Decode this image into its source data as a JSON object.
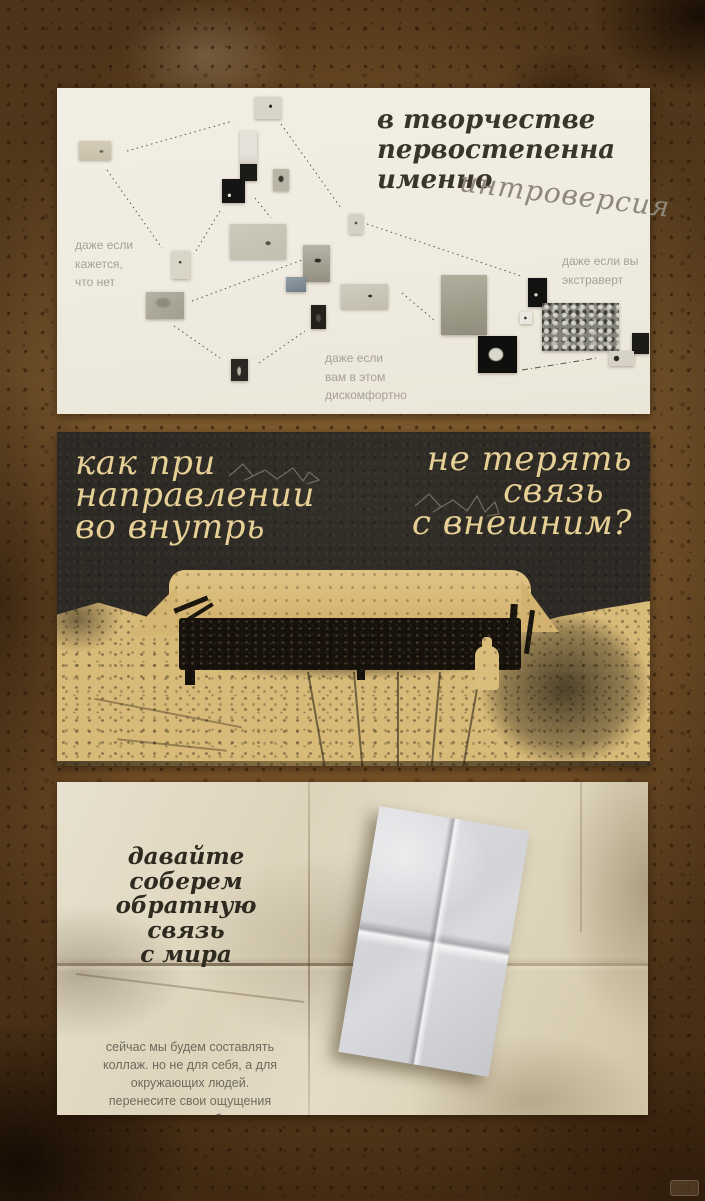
{
  "slides": {
    "intro": {
      "title": [
        "в творчестве",
        "первостепенна",
        "именно"
      ],
      "highlight": "интроверсия",
      "note_left": [
        "даже если",
        "кажется,",
        "что нет"
      ],
      "note_right": [
        "даже если вы",
        "экстраверт"
      ],
      "note_bottom": [
        "даже если",
        "вам в этом",
        "дискомфортно"
      ]
    },
    "question": {
      "left": [
        "как при",
        "направлении",
        "во внутрь"
      ],
      "right": [
        "не терять",
        "связь",
        "с внешним?"
      ]
    },
    "feedback": {
      "title": [
        "давайте соберем",
        "обратную связь",
        "с мира"
      ],
      "body": "сейчас мы будем составлять коллаж. но не для себя, а для окружающих людей. перенесите свои ощущения от человека на бумагу."
    }
  },
  "colors": {
    "coffee_brown": "#75522a",
    "slide_cream": "#efebe0",
    "slide_dark": "#2d2a25",
    "accent_tan_text": "#e6d096",
    "slide_paper_beige": "#ded4bc",
    "ink_dark": "#3a352c",
    "note_gray": "#a6a194"
  }
}
